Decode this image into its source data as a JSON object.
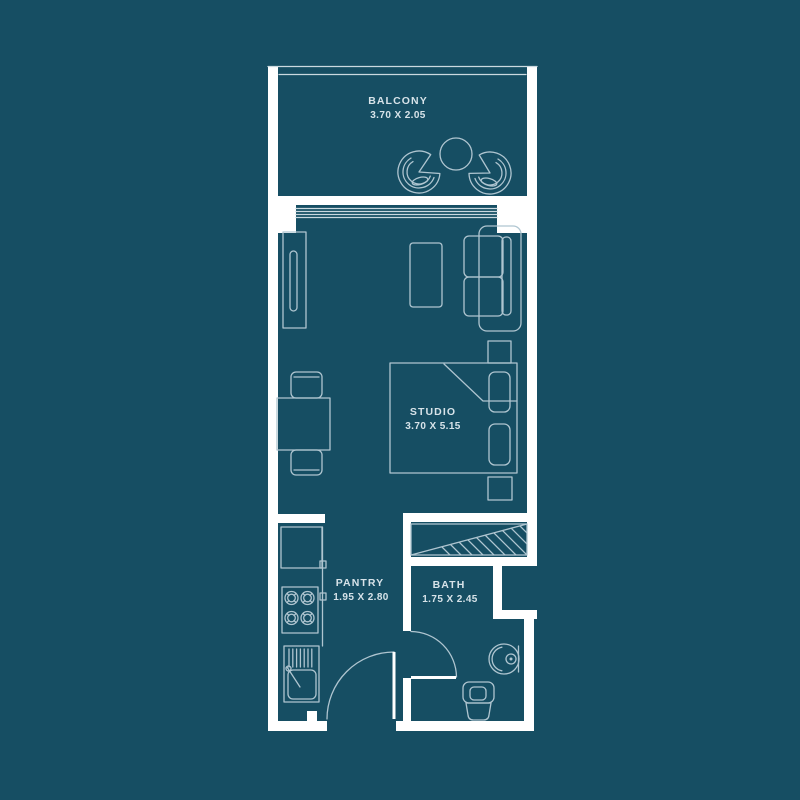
{
  "title": "Studio apartment floor plan",
  "colors": {
    "background": "#164E63",
    "wall": "#FFFFFF",
    "line": "#AFC5D0",
    "bright": "#CBD9E0",
    "text": "#D7E3E9"
  },
  "rooms": {
    "balcony": {
      "label": "BALCONY",
      "dimensions": "3.70 X 2.05"
    },
    "studio": {
      "label": "STUDIO",
      "dimensions": "3.70 X 5.15"
    },
    "pantry": {
      "label": "PANTRY",
      "dimensions": "1.95 X 2.80"
    },
    "bath": {
      "label": "BATH",
      "dimensions": "1.75 X 2.45"
    }
  }
}
